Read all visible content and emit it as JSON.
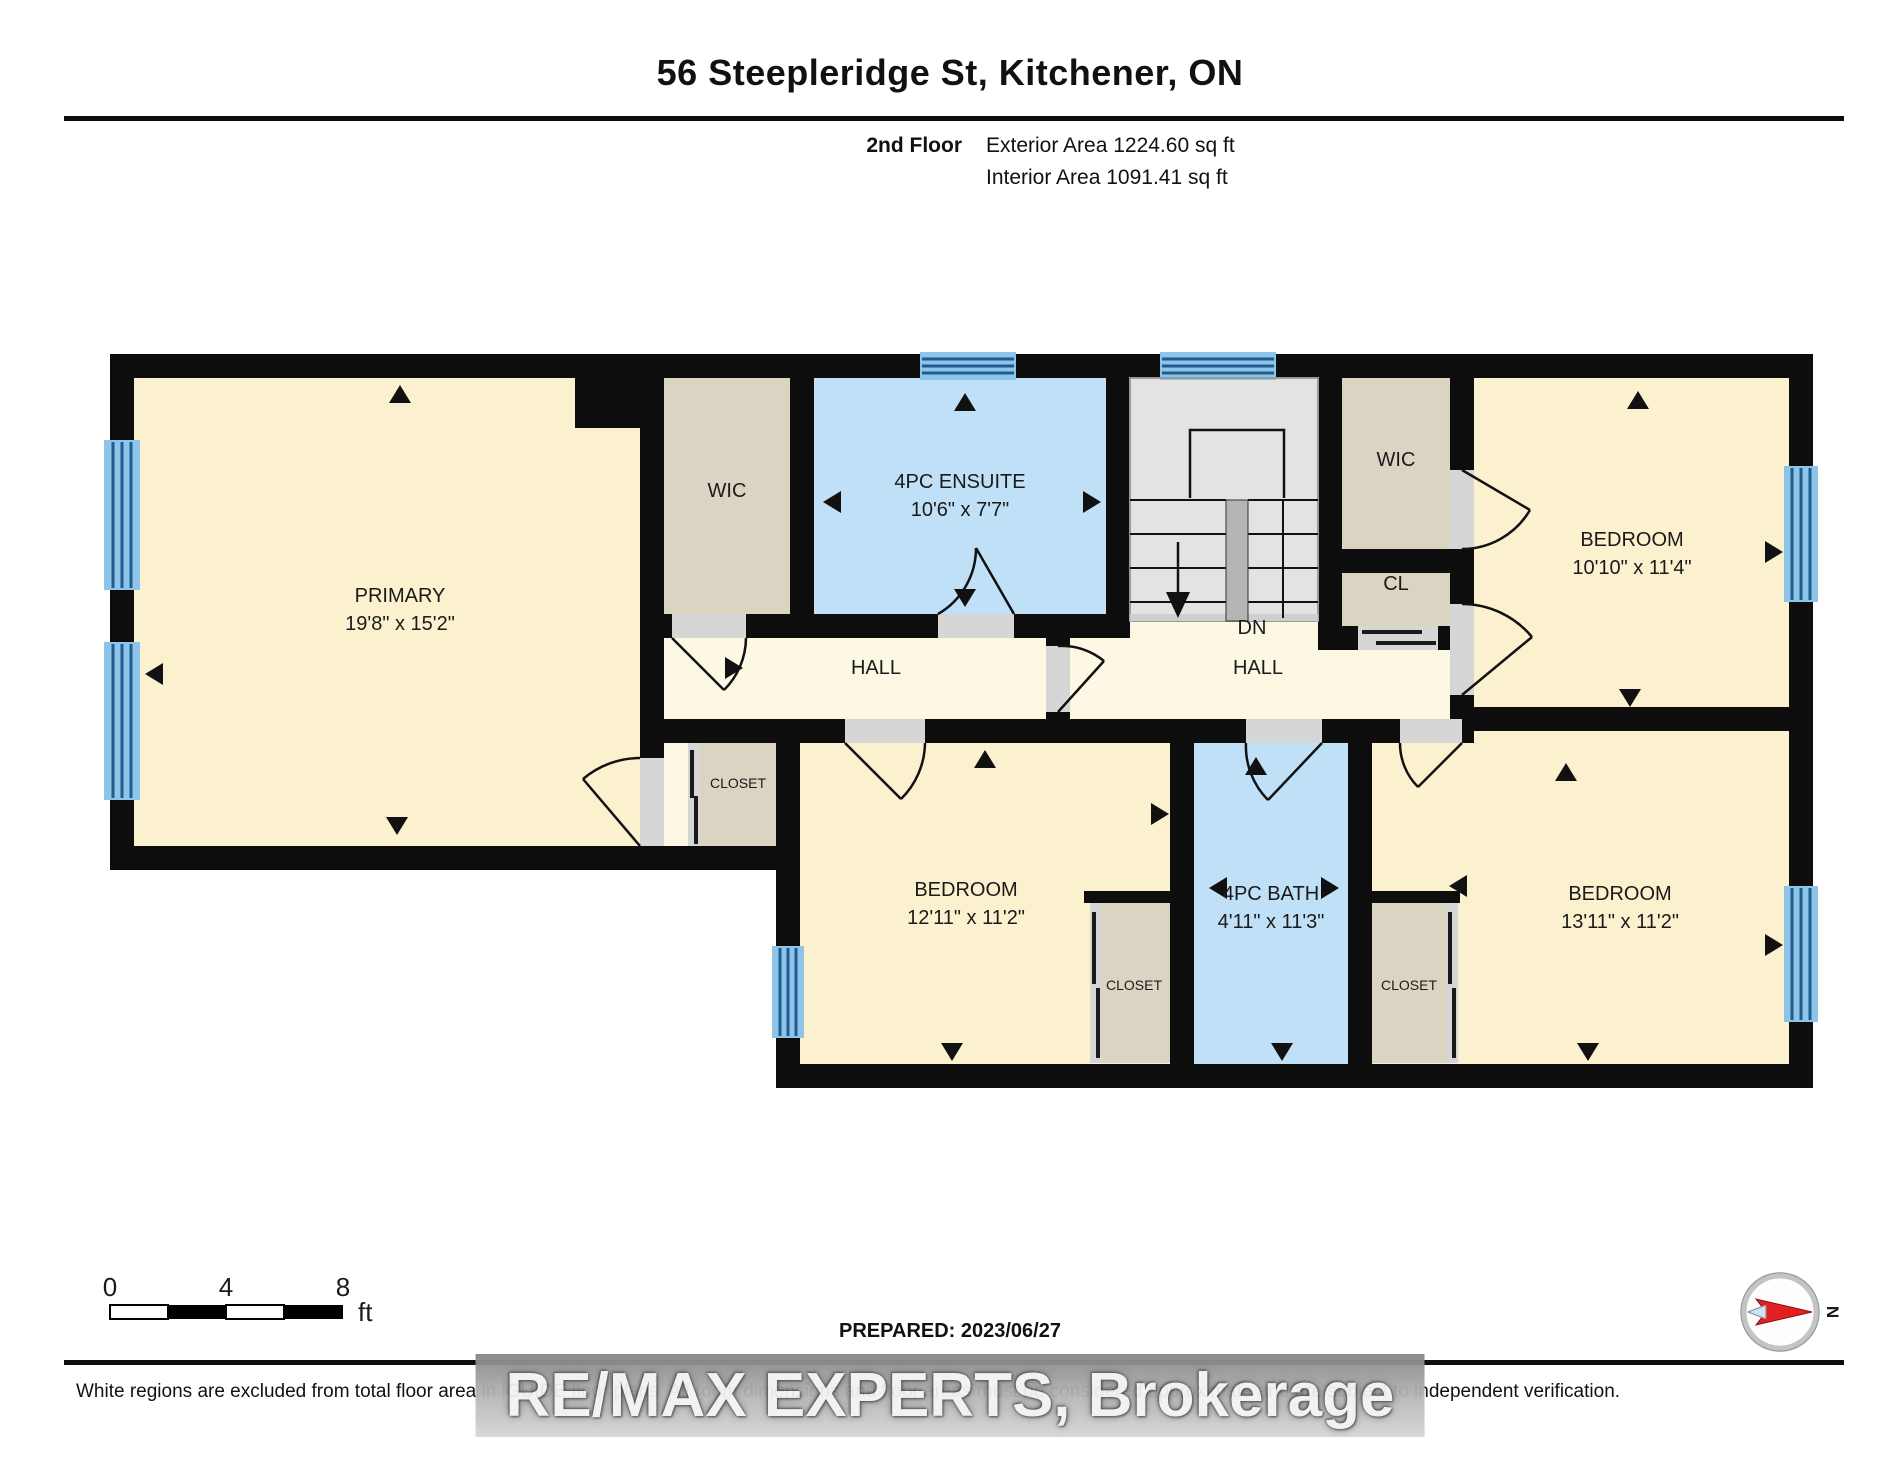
{
  "header": {
    "title": "56 Steepleridge St, Kitchener, ON",
    "floor_label": "2nd Floor",
    "exterior_area": "Exterior Area 1224.60 sq ft",
    "interior_area": "Interior Area 1091.41 sq ft"
  },
  "rooms": {
    "primary": {
      "name": "PRIMARY",
      "dims": "19'8\" x 15'2\""
    },
    "wic_primary": {
      "name": "WIC"
    },
    "ensuite": {
      "name": "4PC ENSUITE",
      "dims": "10'6\" x 7'7\""
    },
    "wic_right": {
      "name": "WIC"
    },
    "cl": {
      "name": "CL"
    },
    "bedroom_top_right": {
      "name": "BEDROOM",
      "dims": "10'10\" x 11'4\""
    },
    "hall_left": {
      "name": "HALL"
    },
    "hall_right": {
      "name": "HALL"
    },
    "stairs": {
      "name": "DN"
    },
    "closet_hall": {
      "name": "CLOSET"
    },
    "bedroom_bottom_middle": {
      "name": "BEDROOM",
      "dims": "12'11\" x 11'2\""
    },
    "bath": {
      "name": "4PC BATH",
      "dims": "4'11\" x 11'3\""
    },
    "closet_left_of_bath": {
      "name": "CLOSET"
    },
    "closet_right_of_bath": {
      "name": "CLOSET"
    },
    "bedroom_bottom_right": {
      "name": "BEDROOM",
      "dims": "13'11\" x 11'2\""
    }
  },
  "scale_bar": {
    "tick_0": "0",
    "tick_4": "4",
    "tick_8": "8",
    "unit": "ft"
  },
  "footer": {
    "prepared": "PREPARED: 2023/06/27",
    "compass_north": "N",
    "disclaimer": "White regions are excluded from total floor area in iGUIDE floor plans. All room dimensions and floor areas must be considered approximate and are subject to independent verification.",
    "watermark": "RE/MAX EXPERTS, Brokerage"
  },
  "colors": {
    "room_fill": "#fbf1cf",
    "hall_fill": "#fdf8e4",
    "closet_fill": "#dcd4c3",
    "bath_fill": "#bfe0f6",
    "stairs_fill": "#e3e3e3",
    "wall": "#0d0d0d",
    "window_blue": "#4f9fd4"
  }
}
